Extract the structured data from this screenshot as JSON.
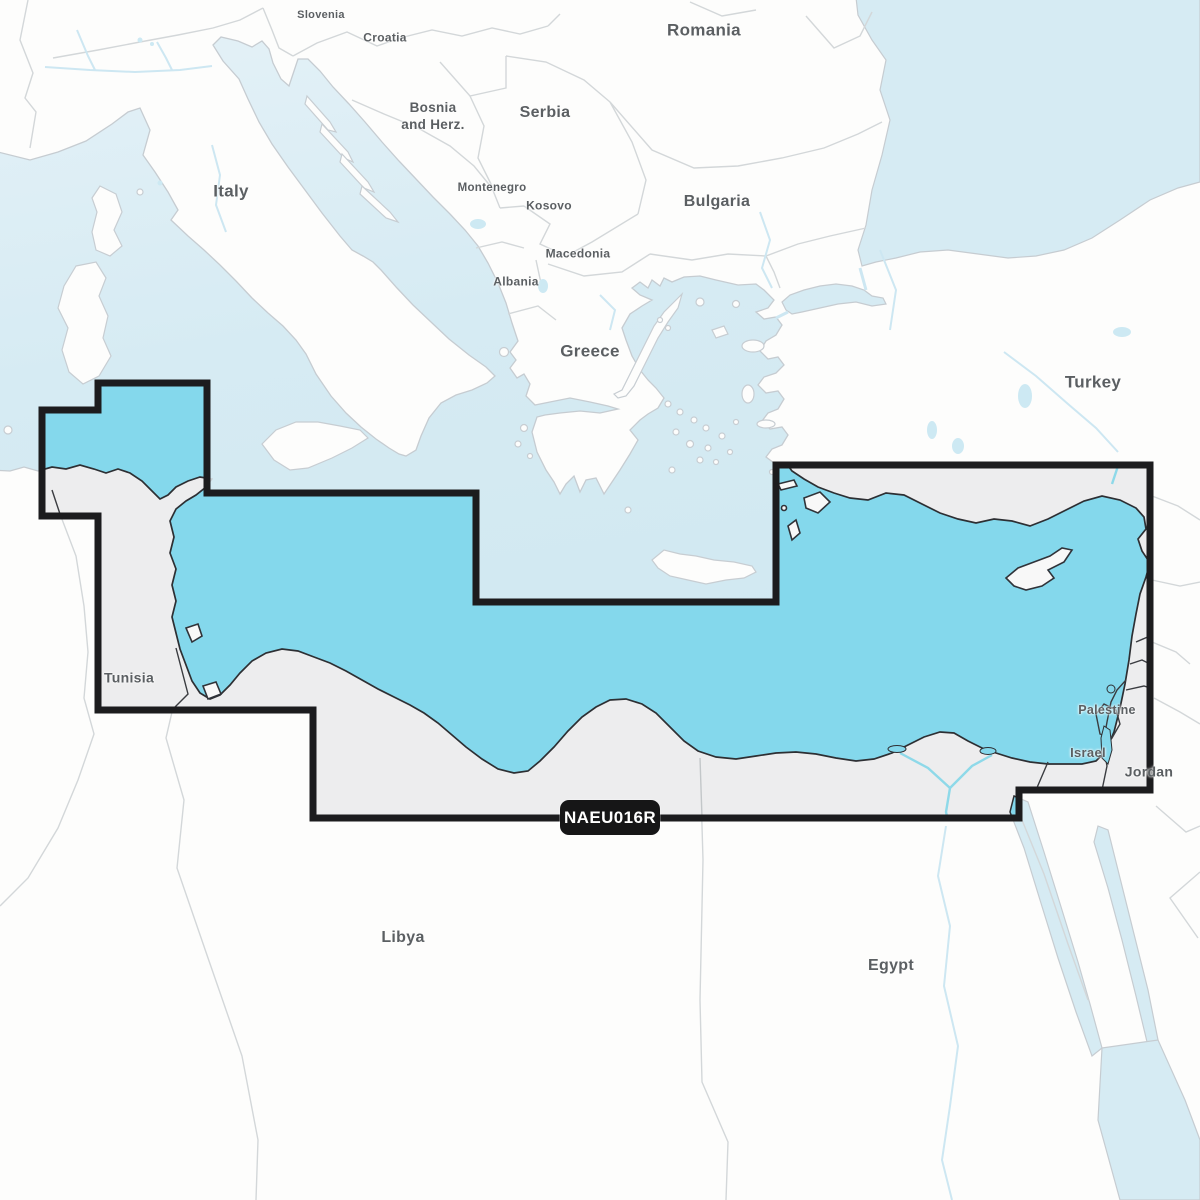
{
  "badge": {
    "text": "NAEU016R"
  },
  "labels": {
    "slovenia": {
      "text": "Slovenia"
    },
    "croatia": {
      "text": "Croatia"
    },
    "bosnia_line1": {
      "text": "Bosnia"
    },
    "bosnia_line2": {
      "text": "and Herz."
    },
    "serbia": {
      "text": "Serbia"
    },
    "montenegro": {
      "text": "Montenegro"
    },
    "kosovo": {
      "text": "Kosovo"
    },
    "macedonia": {
      "text": "Macedonia"
    },
    "albania": {
      "text": "Albania"
    },
    "romania": {
      "text": "Romania"
    },
    "bulgaria": {
      "text": "Bulgaria"
    },
    "italy": {
      "text": "Italy"
    },
    "greece": {
      "text": "Greece"
    },
    "turkey": {
      "text": "Turkey"
    },
    "tunisia": {
      "text": "Tunisia"
    },
    "libya": {
      "text": "Libya"
    },
    "egypt": {
      "text": "Egypt"
    },
    "palestine": {
      "text": "Palestine"
    },
    "israel": {
      "text": "Israel"
    },
    "jordan": {
      "text": "Jordan"
    }
  },
  "colors": {
    "sea_outside": "#d6ebf3",
    "sea_coverage": "#84d8ec",
    "land_outside": "#fdfdfc",
    "land_coverage": "#ededee",
    "coverage_outline": "#1c1c1e",
    "badge_background": "#161617",
    "badge_text": "#ffffff",
    "label_text": "#5b5f62"
  }
}
